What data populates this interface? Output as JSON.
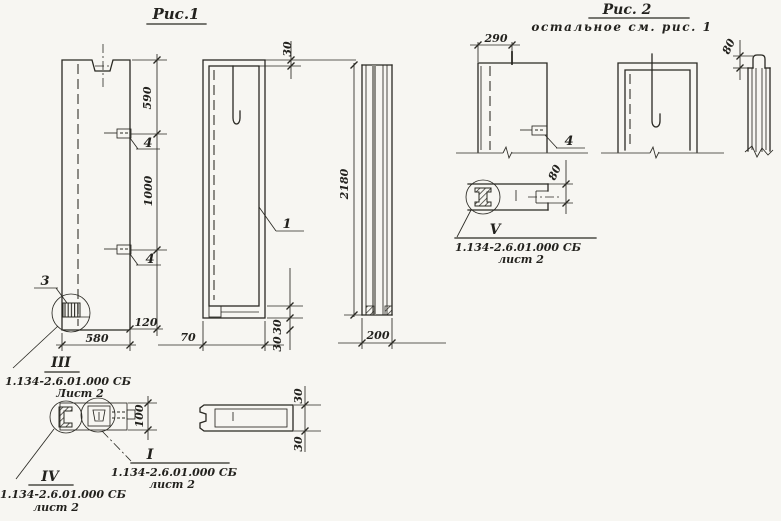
{
  "colors": {
    "paper": "#f7f6f2",
    "ink": "#2a2923"
  },
  "fig1": {
    "title": "Рис.1",
    "rear": {
      "dim590": "590",
      "dim1000": "1000",
      "tag4a": "4",
      "tag4b": "4",
      "tag3": "3",
      "dim120": "120",
      "dim580": "580"
    },
    "front": {
      "dim30top": "30",
      "tag1": "1",
      "dim70": "70",
      "dim30a": "30",
      "dim30b": "30"
    },
    "side": {
      "dim2180": "2180",
      "dim200": "200"
    },
    "plan": {
      "dim30top": "30",
      "dim30bot": "30"
    },
    "detail": {
      "dim100": "100"
    },
    "calloutIII": {
      "num": "III",
      "doc": "1.134-2.6.01.000 СБ",
      "sheet": "Лист 2"
    },
    "calloutIV": {
      "num": "IV",
      "doc": "1.134-2.6.01.000 СБ",
      "sheet": "лист 2"
    },
    "calloutI": {
      "num": "I",
      "doc": "1.134-2.6.01.000 СБ",
      "sheet": "лист 2"
    }
  },
  "fig2": {
    "title": "Рис. 2",
    "subtitle": "остальное см. рис. 1",
    "rear": {
      "dim290": "290",
      "tag4": "4"
    },
    "side": {
      "dim80": "80"
    },
    "detail": {
      "dim80": "80"
    },
    "calloutV": {
      "num": "V",
      "doc": "1.134-2.6.01.000 СБ",
      "sheet": "лист 2"
    }
  }
}
